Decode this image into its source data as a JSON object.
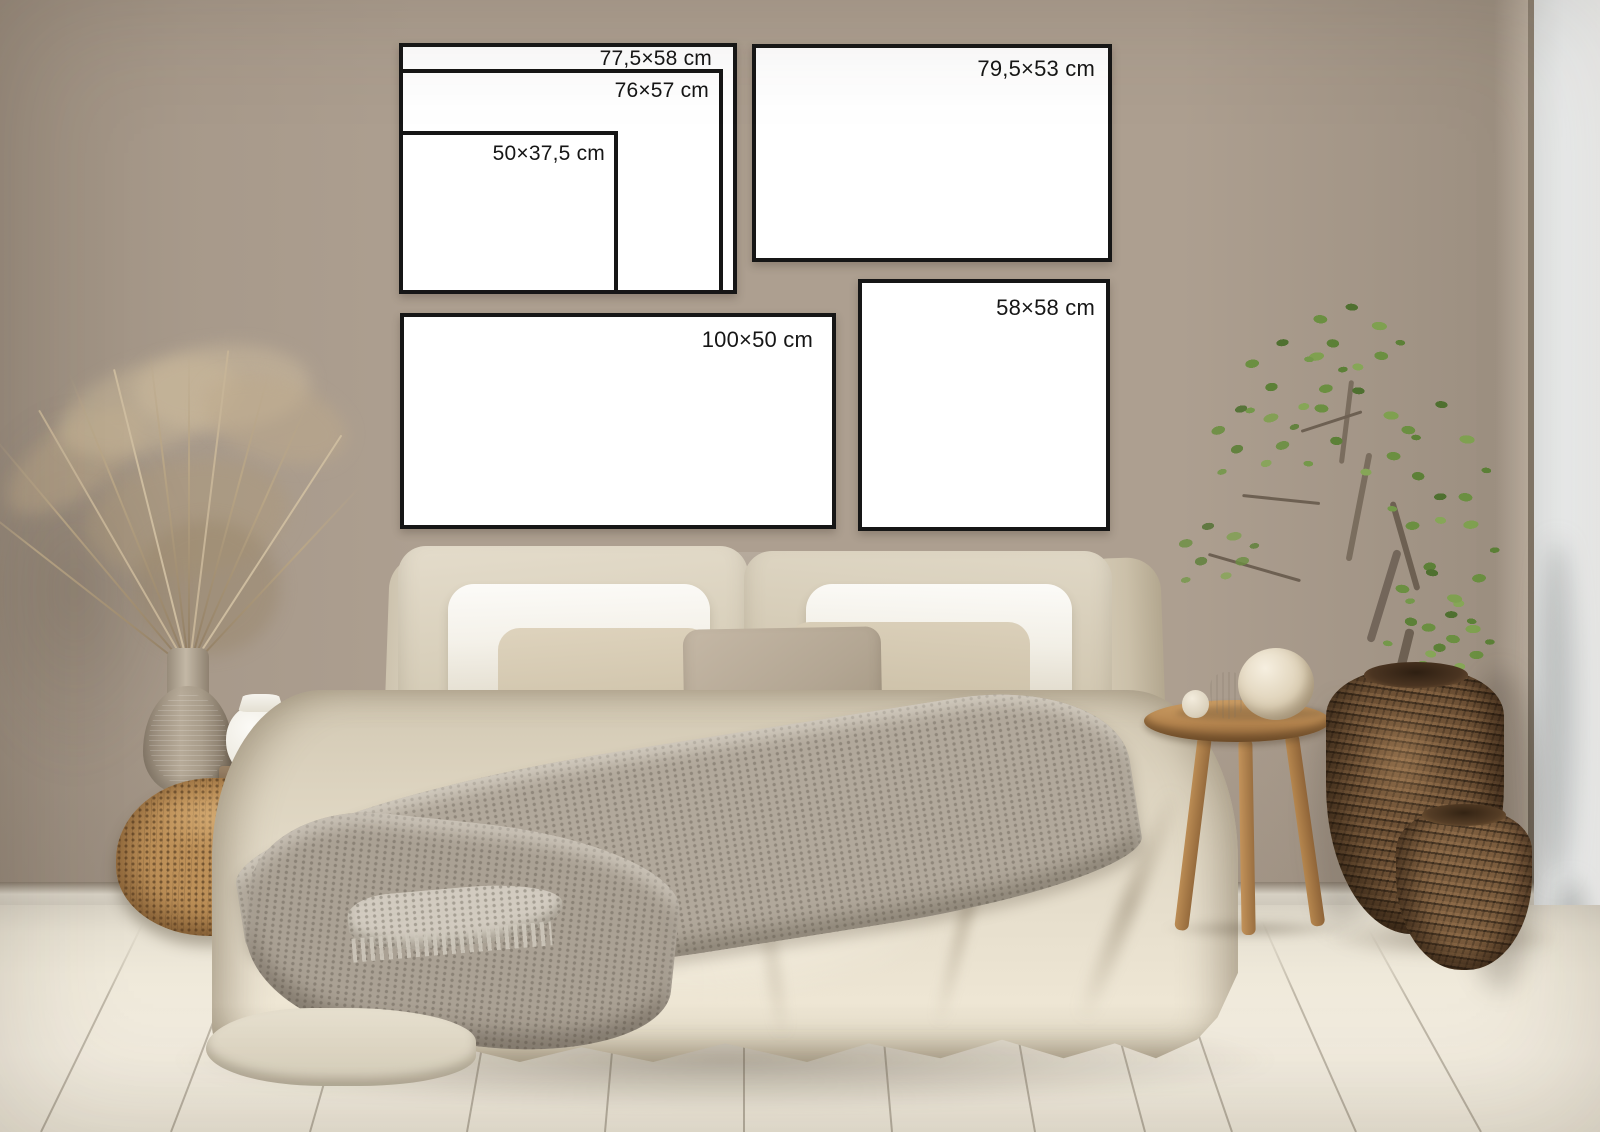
{
  "mockup": {
    "unit": "cm",
    "frames": [
      {
        "id": "frame-77-5x58",
        "label": "77,5×58 cm",
        "width_cm": 77.5,
        "height_cm": 58
      },
      {
        "id": "frame-76x57",
        "label": "76×57 cm",
        "width_cm": 76,
        "height_cm": 57
      },
      {
        "id": "frame-50x37-5",
        "label": "50×37,5 cm",
        "width_cm": 50,
        "height_cm": 37.5
      },
      {
        "id": "frame-79-5x53",
        "label": "79,5×53 cm",
        "width_cm": 79.5,
        "height_cm": 53
      },
      {
        "id": "frame-100x50",
        "label": "100×50 cm",
        "width_cm": 100,
        "height_cm": 50
      },
      {
        "id": "frame-58x58",
        "label": "58×58 cm",
        "width_cm": 58,
        "height_cm": 58
      }
    ],
    "colors": {
      "wall": "#ad9f90",
      "white_wall": "#eef0f0",
      "floor": "#eee8da",
      "frame_fill": "#ffffff",
      "frame_border": "#161616",
      "label_text": "#161616",
      "linen_duvet": "#ddd5c2",
      "white_pillow": "#f6f4ee",
      "euro_sham": "#d5ccb8",
      "throw_blanket": "#aba295",
      "wicker_basket": "#bd9058",
      "wicker_pot": "#6f5236",
      "wood_stool": "#b5854f",
      "plant_green": "#6b8f41",
      "dried_grass": "#b5a287"
    }
  }
}
